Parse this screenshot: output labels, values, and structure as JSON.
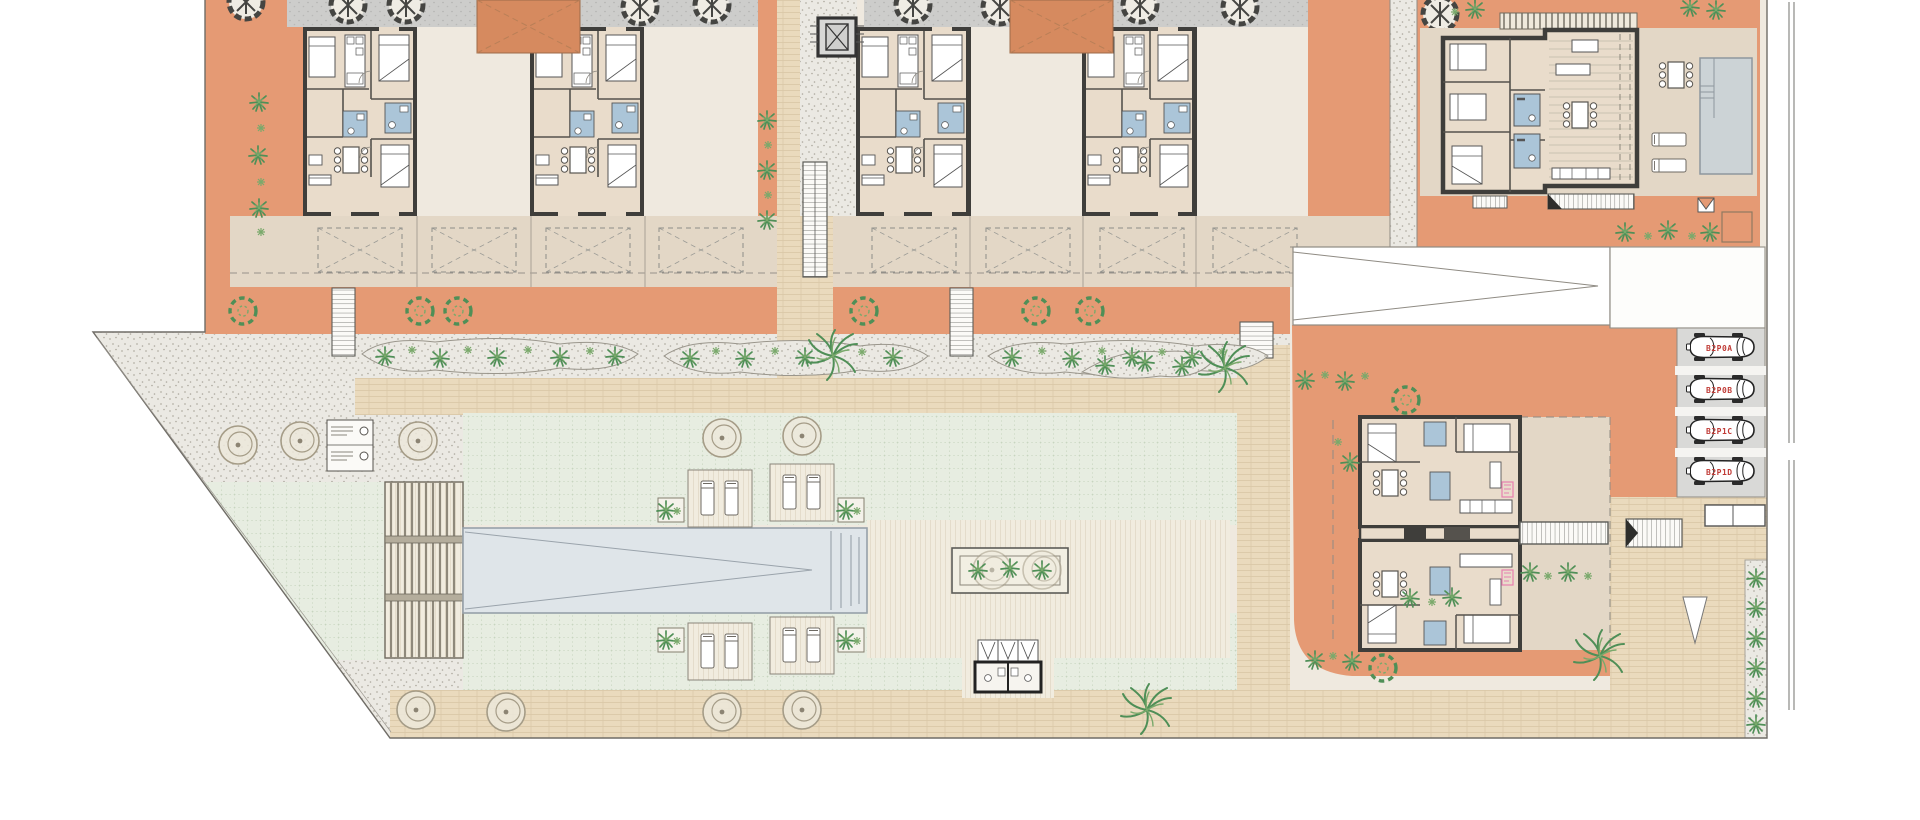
{
  "title": "residential-site-plan",
  "parking": {
    "labels": [
      "B2P0A",
      "B2P0B",
      "B2P1C",
      "B2P1D"
    ]
  },
  "legend": {
    "items": [
      {
        "symbol": "circle-drain"
      },
      {
        "symbol": "circle-drain"
      }
    ]
  },
  "colors": {
    "terr": "#e59a74",
    "terrd": "#d68a5f",
    "floor": "#e9dccb",
    "band": "#e3d7c6",
    "wall": "#3f3e3b",
    "bath": "#abc5d8",
    "roof": "#cdcdcb",
    "lawn": "#e7ede1",
    "gravel": "#ebe9e3",
    "brick": "#eadabd",
    "brickline": "#cfba98",
    "deck": "#f1ecdf",
    "pool": "#dfe5e9",
    "stall": "#d9d9d7",
    "palm": "#4f8f57",
    "palm2": "#7aa96b",
    "gtree": "#a59c87",
    "label_red": "#c03b36",
    "pink": "#e87fb0"
  }
}
